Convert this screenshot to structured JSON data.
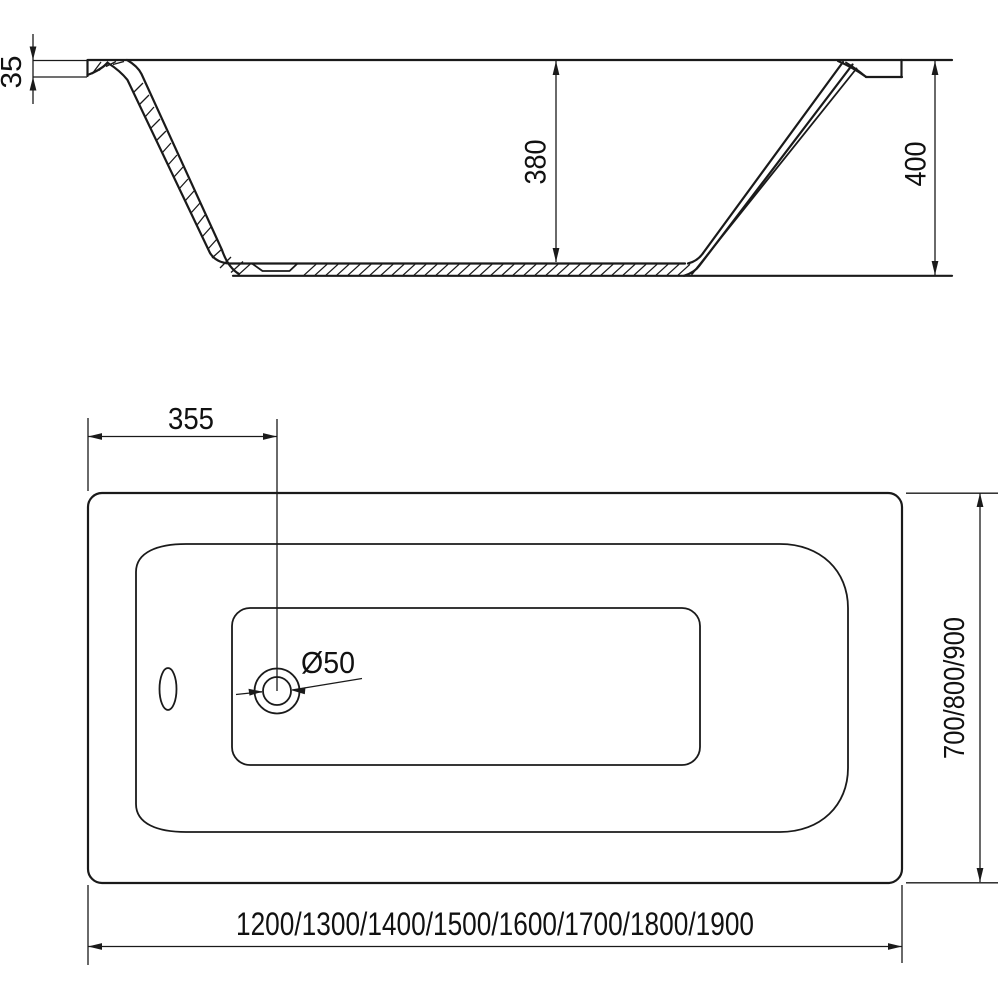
{
  "drawing": {
    "title": "bathtub-technical-drawing",
    "colors": {
      "line": "#1a1a1a",
      "background": "#ffffff"
    },
    "side_view": {
      "rim_thickness": "35",
      "inner_depth": "380",
      "overall_height": "400"
    },
    "plan_view": {
      "drain_offset": "355",
      "drain_diameter": "Ø50",
      "length_options": "1200/1300/1400/1500/1600/1700/1800/1900",
      "width_options": "700/800/900"
    }
  }
}
